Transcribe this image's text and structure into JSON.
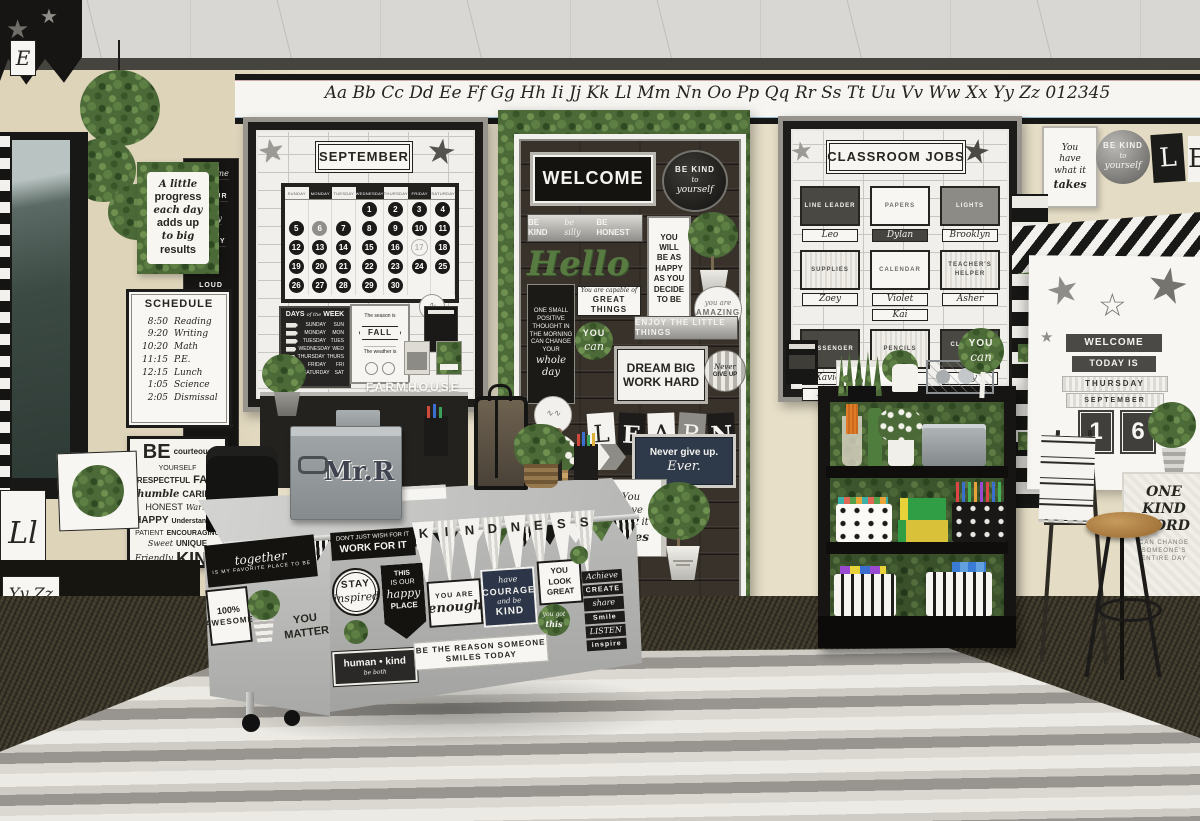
{
  "corner_display": {
    "letter": "E"
  },
  "alphabet_banner": {
    "text": "Aa Bb Cc Dd Ee Ff Gg Hh Ii Jj Kk Ll Mm Nn Oo Pp Qq Rr Ss Tt Uu Vv Ww Xx Yy Zz 012345"
  },
  "left_wall": {
    "hanging_banner": {
      "words": [
        "welcome",
        "TO OUR",
        "crazy",
        "HAPPY",
        "fun",
        "LOUD",
        "caring",
        "INSPIRED",
        "kind",
        "SWEET",
        "great",
        "AWESOME",
        "class"
      ]
    },
    "progress_poster": {
      "lines": [
        "A little",
        "progress",
        "each day",
        "adds up",
        "to big",
        "results"
      ]
    },
    "schedule": {
      "title": "SCHEDULE",
      "items": [
        {
          "time": "8:50",
          "subject": "Reading"
        },
        {
          "time": "9:20",
          "subject": "Writing"
        },
        {
          "time": "10:20",
          "subject": "Math"
        },
        {
          "time": "11:15",
          "subject": "P.E."
        },
        {
          "time": "12:15",
          "subject": "Lunch"
        },
        {
          "time": "1:05",
          "subject": "Science"
        },
        {
          "time": "2:05",
          "subject": "Dismissal"
        }
      ]
    },
    "be_poster": {
      "words": [
        "BE",
        "courteous",
        "YOURSELF",
        "RESPECTFUL",
        "FAIR",
        "humble",
        "CARING",
        "HONEST",
        "Warm",
        "HAPPY",
        "Understanding",
        "PATIENT",
        "ENCOURAGING",
        "Sweet",
        "UNIQUE",
        "Friendly",
        "KIND"
      ]
    },
    "letter_cards": [
      "Ll",
      "Yy Zz"
    ]
  },
  "september_board": {
    "title": "SEPTEMBER",
    "calendar": {
      "day_headers": [
        "SUNDAY",
        "MONDAY",
        "TUESDAY",
        "WEDNESDAY",
        "THURSDAY",
        "FRIDAY",
        "SATURDAY"
      ],
      "weeks": [
        [
          "",
          "",
          "",
          "1",
          "2",
          "3",
          "4"
        ],
        [
          "5",
          "6",
          "7",
          "8",
          "9",
          "10",
          "11"
        ],
        [
          "12",
          "13",
          "14",
          "15",
          "16",
          "17",
          "18"
        ],
        [
          "19",
          "20",
          "21",
          "22",
          "23",
          "24",
          "25"
        ],
        [
          "26",
          "27",
          "28",
          "29",
          "30",
          "",
          ""
        ]
      ],
      "specials": {
        "6": "solid-gray",
        "17": "outline"
      }
    },
    "days_chart": {
      "title_a": "DAYS",
      "title_b": "of the",
      "title_c": "WEEK",
      "rows": [
        [
          "SUNDAY",
          "SUN"
        ],
        [
          "MONDAY",
          "MON"
        ],
        [
          "TUESDAY",
          "TUES"
        ],
        [
          "WEDNESDAY",
          "WED"
        ],
        [
          "THURSDAY",
          "THURS"
        ],
        [
          "FRIDAY",
          "FRI"
        ],
        [
          "SATURDAY",
          "SAT"
        ]
      ]
    },
    "season_chart": {
      "season_label": "The season is",
      "season_value": "FALL",
      "weather_label": "The weather is"
    },
    "farmhouse_sign": "FARMHOUSE"
  },
  "welcome_board": {
    "welcome": "WELCOME",
    "be_kind_circle": [
      "BE KIND",
      "to",
      "yourself"
    ],
    "kind_silly_honest": [
      "BE KIND",
      "be silly",
      "BE HONEST"
    ],
    "hello": "Hello",
    "happy_card": [
      "YOU",
      "WILL",
      "BE AS",
      "HAPPY",
      "AS YOU",
      "DECIDE",
      "TO BE"
    ],
    "thought_card": [
      "ONE SMALL",
      "POSITIVE",
      "THOUGHT IN",
      "THE MORNING",
      "CAN CHANGE",
      "YOUR",
      "whole",
      "day"
    ],
    "great_things": [
      "You are capable of",
      "GREAT THINGS"
    ],
    "amazing_circle": [
      "you are",
      "AMAZING"
    ],
    "you_can_circle": [
      "YOU",
      "can"
    ],
    "enjoy_strip": "ENJOY THE LITTLE THINGS",
    "dream_frame": [
      "DREAM BIG",
      "WORK HARD"
    ],
    "never_circle": [
      "Never",
      "GIVE UP"
    ],
    "learn_letters": [
      "L",
      "E",
      "A",
      "R",
      "N"
    ],
    "never_ever": [
      "Never give up.",
      "Ever."
    ],
    "takes_card": [
      "You",
      "have",
      "what it",
      "takes"
    ],
    "difference_strip": [
      "thing that makes a",
      "difference"
    ]
  },
  "jobs_board": {
    "title": "CLASSROOM JOBS",
    "jobs": [
      {
        "job": "LINE LEADER",
        "names": [
          "Leo"
        ],
        "style": "dark"
      },
      {
        "job": "PAPERS",
        "names": [
          "Dylan"
        ],
        "style": "light",
        "dark_name_index": 0
      },
      {
        "job": "LIGHTS",
        "names": [
          "Brooklyn"
        ],
        "style": "gray"
      },
      {
        "job": "SUPPLIES",
        "names": [
          "Zoey"
        ],
        "style": "striped"
      },
      {
        "job": "CALENDAR",
        "names": [
          "Violet",
          "Kai"
        ],
        "style": "light"
      },
      {
        "job": "TEACHER'S HELPER",
        "names": [
          "Asher"
        ],
        "style": "striped"
      },
      {
        "job": "MESSENGER",
        "names": [
          "Xavier",
          "Elena"
        ],
        "style": "dark"
      },
      {
        "job": "PENCILS",
        "names": [
          "Bella"
        ],
        "style": "striped"
      },
      {
        "job": "CLEAN-UP CREW",
        "names": [
          "Ivy",
          "Roman"
        ],
        "style": "dark"
      }
    ],
    "you_can_circle": [
      "YOU",
      "can"
    ]
  },
  "right_wall": {
    "takes_poster": [
      "You",
      "have",
      "what it",
      "takes"
    ],
    "be_kind_circle": [
      "BE KIND",
      "to",
      "yourself"
    ],
    "letter_cards": [
      "L",
      "E"
    ],
    "today_board": {
      "welcome": "WELCOME",
      "today_is": "TODAY IS",
      "day": "THURSDAY",
      "month": "SEPTEMBER",
      "date_digits": [
        "1",
        "6"
      ]
    },
    "one_kind_poster": {
      "big": [
        "ONE",
        "KIND",
        "WORD"
      ],
      "small": [
        "CAN CHANGE",
        "SOMEONE'S",
        "ENTIRE DAY"
      ]
    }
  },
  "desk": {
    "bin_label": "Mr.R",
    "work_for_it": [
      "DON'T JUST WISH FOR IT",
      "WORK FOR IT"
    ],
    "kindness_letters": [
      "K",
      "I",
      "N",
      "D",
      "N",
      "E",
      "S",
      "S"
    ],
    "stay_circle": [
      "STAY",
      "inspired"
    ],
    "happy_place": [
      "THIS",
      "IS OUR",
      "happy",
      "PLACE"
    ],
    "enough_card": [
      "YOU ARE",
      "enough"
    ],
    "courage_card": [
      "have",
      "COURAGE",
      "and be",
      "KIND"
    ],
    "look_great": [
      "YOU",
      "LOOK",
      "GREAT"
    ],
    "word_list": [
      "Achieve",
      "CREATE",
      "share",
      "Smile",
      "LISTEN",
      "inspire"
    ],
    "got_this": [
      "you got",
      "this"
    ],
    "together_banner": {
      "script": "together",
      "rest": "IS MY FAVORITE PLACE TO BE"
    },
    "awesome_card": [
      "100%",
      "AWESOME"
    ],
    "you_matter": [
      "YOU",
      "MATTER"
    ],
    "human_kind": [
      "human • kind",
      "be both"
    ],
    "be_the_reason": "BE THE REASON SOMEONE SMILES TODAY"
  },
  "colors": {
    "wall": "#e8e0c9",
    "greenery": "#4c6a38",
    "board_black": "#1d1c1a",
    "navy": "#2e3a4a",
    "moss": "#5d7f46"
  }
}
